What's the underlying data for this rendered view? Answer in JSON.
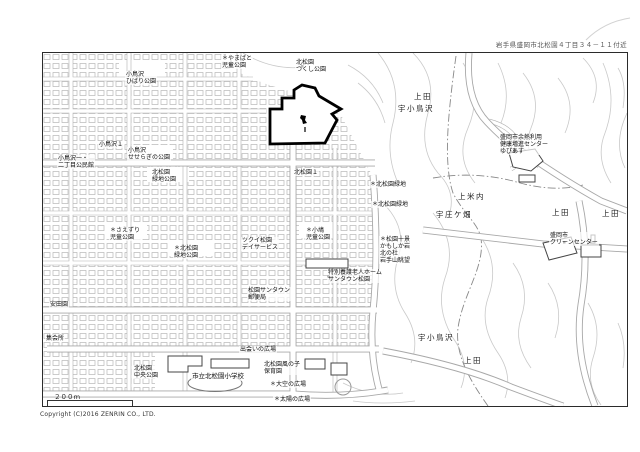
{
  "header": {
    "address": "岩手県盛岡市北松園４丁目３４－１１付近"
  },
  "footer": {
    "copyright": "Copyright (C)2016 ZENRIN CO., LTD.",
    "scale_label": "２００ｍ"
  },
  "colors": {
    "parcel_outline": "#000000",
    "contour": "#c9c9c9",
    "road_casing": "#a8a8a8",
    "house_block": "#b6b6b6"
  },
  "map": {
    "labels": [
      {
        "text": "＊やまばと\n児童公園"
      },
      {
        "text": "小鳥沢\nひばり公園"
      },
      {
        "text": "北松園\nつくし公園"
      },
      {
        "text": "上田"
      },
      {
        "text": "宇小鳥沢"
      },
      {
        "text": "小鳥沢１"
      },
      {
        "text": "小鳥沢\nせせらぎの公園"
      },
      {
        "text": "小鳥沢一・\n二丁目公民館"
      },
      {
        "text": "北松園１"
      },
      {
        "text": "北松園\n緑地公園"
      },
      {
        "text": "＊北松園\n緑地公園"
      },
      {
        "text": "ツクイ松園\nデイサービス"
      },
      {
        "text": "＊小鳩\n児童公園"
      },
      {
        "text": "松園サンタウン\n郵便局"
      },
      {
        "text": "特別養護老人ホーム\nサンタウン松園"
      },
      {
        "text": "＊松園十景\nかもしか岩\n北の杜\n岩手山眺望"
      },
      {
        "text": "＊北松園緑地"
      },
      {
        "text": "＊北松園緑地"
      },
      {
        "text": "宇庄ケ畑"
      },
      {
        "text": "上米内"
      },
      {
        "text": "上田"
      },
      {
        "text": "上田"
      },
      {
        "text": "盛岡市余熱利用\n健康増進センター\nゆぴあす"
      },
      {
        "text": "盛岡市\nクリーンセンター"
      },
      {
        "text": "宇小鳥沢"
      },
      {
        "text": "上田"
      },
      {
        "text": "出会いの広場"
      },
      {
        "text": "市立北松園小学校"
      },
      {
        "text": "北松園風の子\n保育園"
      },
      {
        "text": "＊大空の広場"
      },
      {
        "text": "＊太陽の広場"
      },
      {
        "text": "北松園\n中央公園"
      },
      {
        "text": "＊さえずり\n児童公園"
      },
      {
        "text": "安田園"
      },
      {
        "text": "集会所"
      }
    ]
  }
}
